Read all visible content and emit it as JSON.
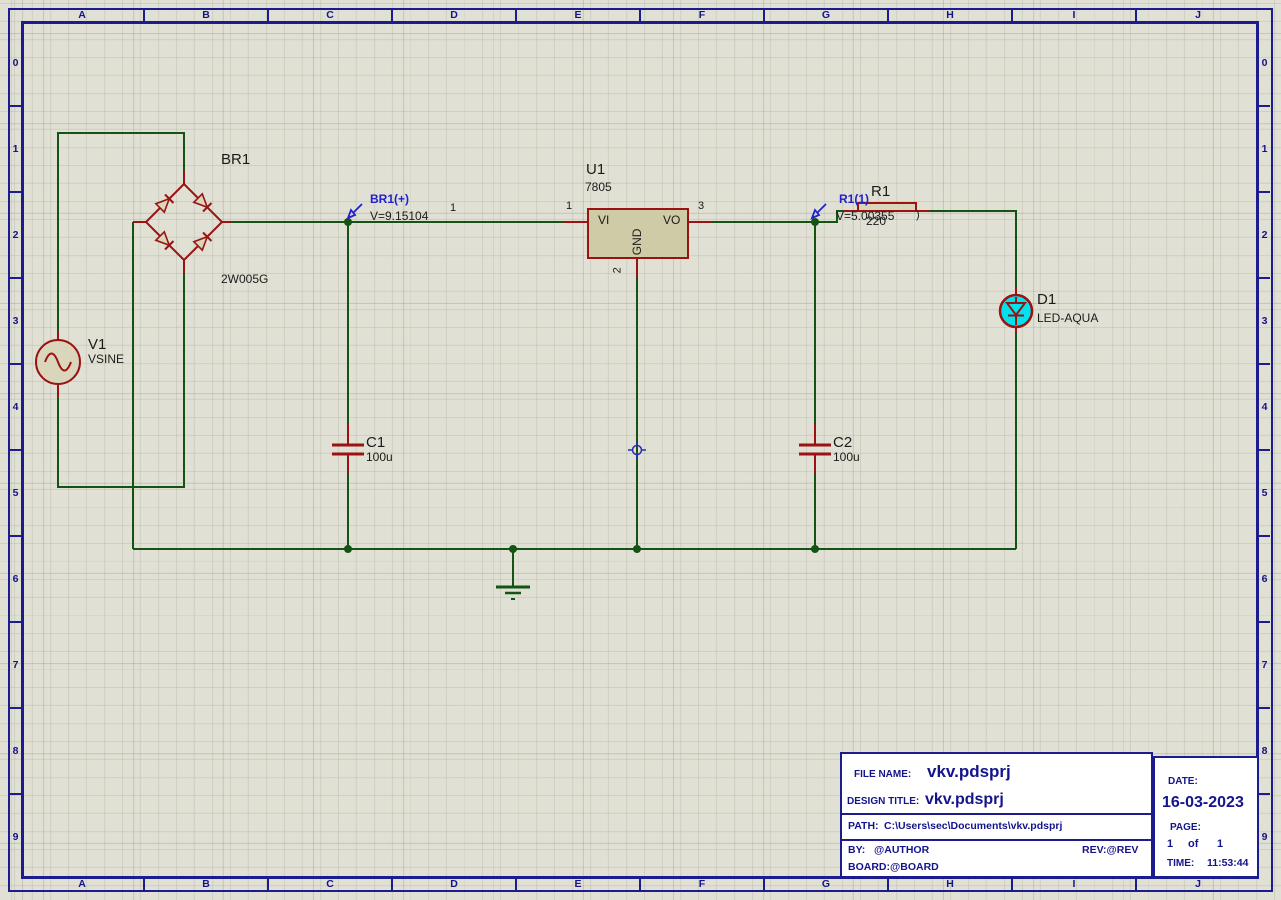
{
  "sheet": {
    "editor": "schematic-capture-canvas",
    "ruler": {
      "columns": [
        "A",
        "B",
        "C",
        "D",
        "E",
        "F",
        "G",
        "H",
        "I",
        "J"
      ],
      "rows": [
        "0",
        "1",
        "2",
        "3",
        "4",
        "5",
        "6",
        "7",
        "8",
        "9"
      ]
    }
  },
  "components": {
    "v1": {
      "ref": "V1",
      "value": "VSINE"
    },
    "br1": {
      "ref": "BR1",
      "value": "2W005G",
      "pin1": "1"
    },
    "u1": {
      "ref": "U1",
      "value": "7805",
      "pin_vi": "VI",
      "pin_vo": "VO",
      "pin_gnd": "GND",
      "pin1": "1",
      "pin2": "2",
      "pin3": "3"
    },
    "c1": {
      "ref": "C1",
      "value": "100u"
    },
    "c2": {
      "ref": "C2",
      "value": "100u"
    },
    "r1": {
      "ref": "R1",
      "value": "220",
      "pin_mark": ")"
    },
    "d1": {
      "ref": "D1",
      "value": "LED-AQUA"
    }
  },
  "probes": {
    "br1_plus": {
      "label": "BR1(+)",
      "value": "V=9.15104"
    },
    "r1_1": {
      "label": "R1(1)",
      "value": "V=5.00355"
    }
  },
  "title_block": {
    "file_name_label": "FILE NAME:",
    "file_name": "vkv.pdsprj",
    "design_title_label": "DESIGN TITLE:",
    "design_title": "vkv.pdsprj",
    "path_label": "PATH:",
    "path": "C:\\Users\\sec\\Documents\\vkv.pdsprj",
    "by_label": "BY:",
    "by": "@AUTHOR",
    "rev": "REV:@REV",
    "board_label": "BOARD:",
    "board": "@BOARD",
    "date_label": "DATE:",
    "date": "16-03-2023",
    "page_label": "PAGE:",
    "page": "1",
    "page_of": "of",
    "page_total": "1",
    "time_label": "TIME:",
    "time": "11:53:44"
  },
  "colors": {
    "wire": "#155315",
    "component_outline": "#9a1212",
    "component_fill": "#d9d6bc",
    "frame": "#1c1c8f",
    "probe_blue": "#2121ce",
    "led_fill": "#00e3ee",
    "background": "#e0e0d4"
  }
}
